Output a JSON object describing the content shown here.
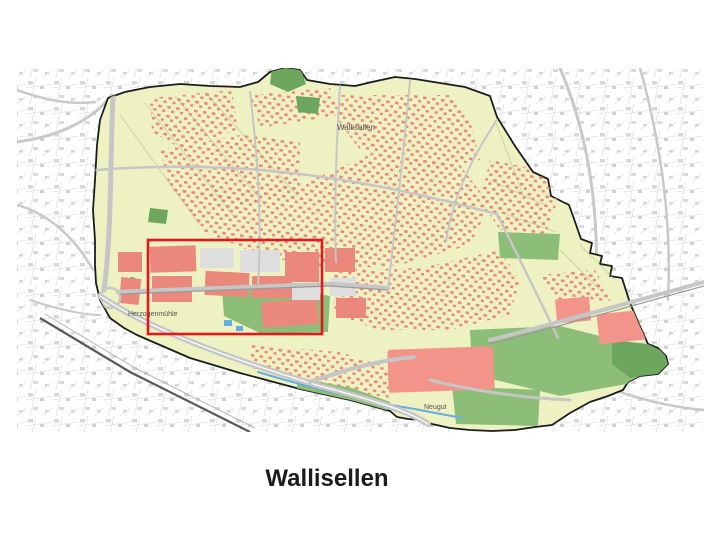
{
  "slide": {
    "caption": "Wallisellen",
    "caption_color": "#1c1c1c"
  },
  "map": {
    "description": "Zoning map of the municipality of Wallisellen with red highlight rectangle over the Herzogenmuehle industrial area",
    "labels": [
      {
        "text": "Wallisellen",
        "x": 337,
        "y": 130
      },
      {
        "text": "Herzogenmühle",
        "x": 128,
        "y": 316
      },
      {
        "text": "Neugut",
        "x": 424,
        "y": 409
      }
    ],
    "highlight_rect": {
      "x": 148,
      "y": 240,
      "width": 174,
      "height": 94
    },
    "colors": {
      "municipality_fill": "#eef2c3",
      "boundary_black": "#1c1c1c",
      "building_red": "#ea887b",
      "zone_salmon": "#f2948a",
      "block_gray": "#dedede",
      "green_mid": "#8cbe78",
      "green_dark": "#6ca75d",
      "road_gray": "#c6c6c6",
      "water_blue": "#62aede",
      "highlight_red": "#e2181b",
      "parcel_line": "#c3cc96",
      "label_gray": "#55524e",
      "caption_color": "#1c1c1c"
    }
  }
}
